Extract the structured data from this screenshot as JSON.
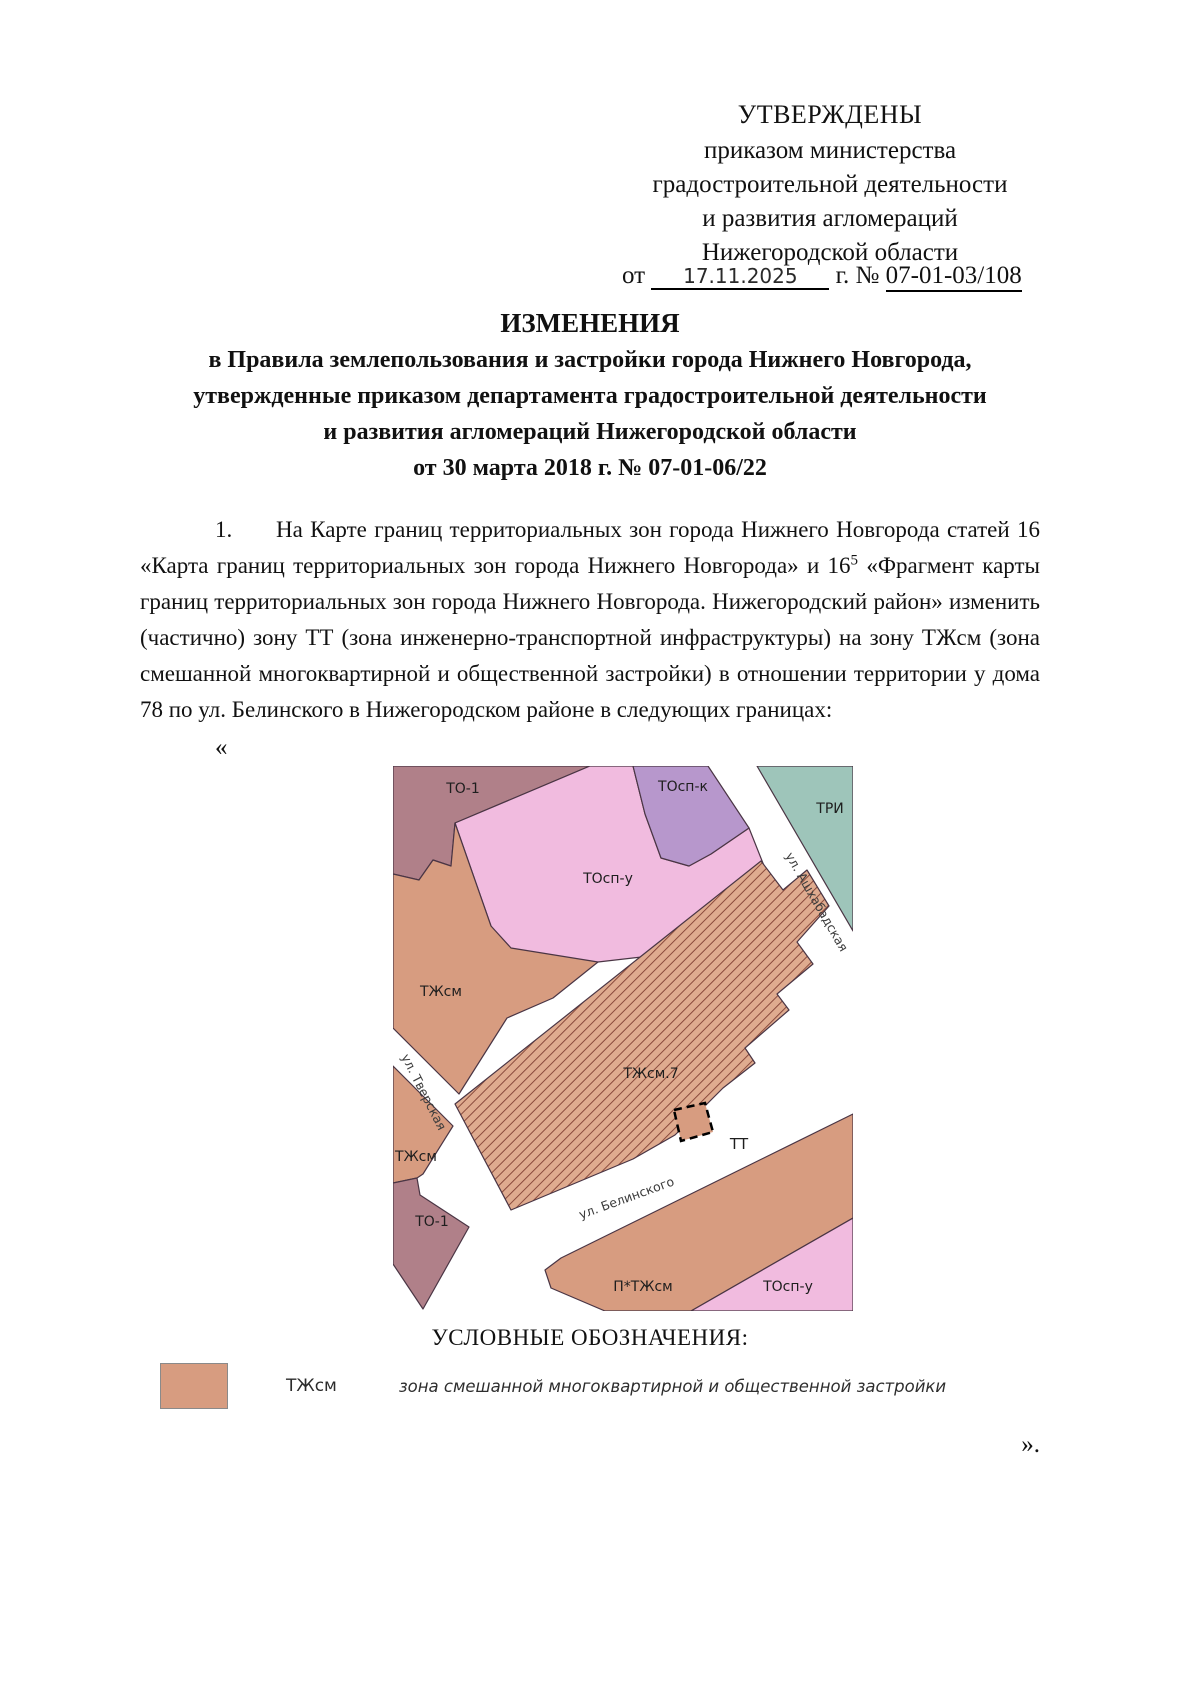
{
  "approval": {
    "line1": "УТВЕРЖДЕНЫ",
    "line2": "приказом министерства",
    "line3": "градостроительной деятельности",
    "line4": "и развития агломераций",
    "line5": "Нижегородской области",
    "date_prefix": "от",
    "date_value": "17.11.2025",
    "date_suffix": "г. №",
    "order_number": "07-01-03/108"
  },
  "title": {
    "heading": "ИЗМЕНЕНИЯ",
    "line1": "в Правила землепользования и застройки города Нижнего Новгорода,",
    "line2": "утвержденные приказом департамента градостроительной деятельности",
    "line3": "и развития агломераций Нижегородской области",
    "line4": "от 30 марта 2018 г. № 07-01-06/22"
  },
  "body": {
    "before_sup": "1.      На Карте границ территориальных зон города Нижнего Новгорода статей 16 «Карта границ территориальных зон города Нижнего Новгорода» и 16",
    "sup": "5",
    "after_sup": " «Фрагмент карты границ территориальных зон города Нижнего Новгорода. Нижегородский район» изменить (частично) зону ТТ (зона инженерно-транспортной инфраструктуры) на зону ТЖсм (зона смешанной многоквартирной и общественной застройки) в отношении территории у дома 78 по ул. Белинского в Нижегородском районе в следующих границах:",
    "open_quote": "«",
    "close_quote": "»."
  },
  "map": {
    "labels": {
      "to1_top": "ТО-1",
      "tosp_k": "ТОсп-к",
      "tri": "ТРИ",
      "tosp_u_top": "ТОсп-у",
      "tzhsm_upper": "ТЖсм",
      "tzhsm7": "ТЖсм.7",
      "tzhsm_lower": "ТЖсм",
      "tt": "ТТ",
      "to1_bottom": "ТО-1",
      "p_tzhsm": "П*ТЖсм",
      "tosp_u_bottom": "ТОсп-у"
    },
    "streets": {
      "ashkhabadskaya": "ул. Ашхабадская",
      "tverskaya": "ул. Тверская",
      "belinskogo": "ул. Белинского"
    },
    "colors": {
      "to1": "#b08089",
      "tosp_u": "#f1bbdf",
      "tosp_k": "#b797cc",
      "tri": "#9ec5ba",
      "tzhsm": "#d79c80",
      "hatch_base": "#dfab8f",
      "hatch_line": "#8a4a3c"
    }
  },
  "legend": {
    "heading": "УСЛОВНЫЕ ОБОЗНАЧЕНИЯ:",
    "items": [
      {
        "swatch_color": "#d79c80",
        "code": "ТЖсм",
        "description": "зона смешанной многоквартирной и общественной застройки"
      }
    ]
  }
}
